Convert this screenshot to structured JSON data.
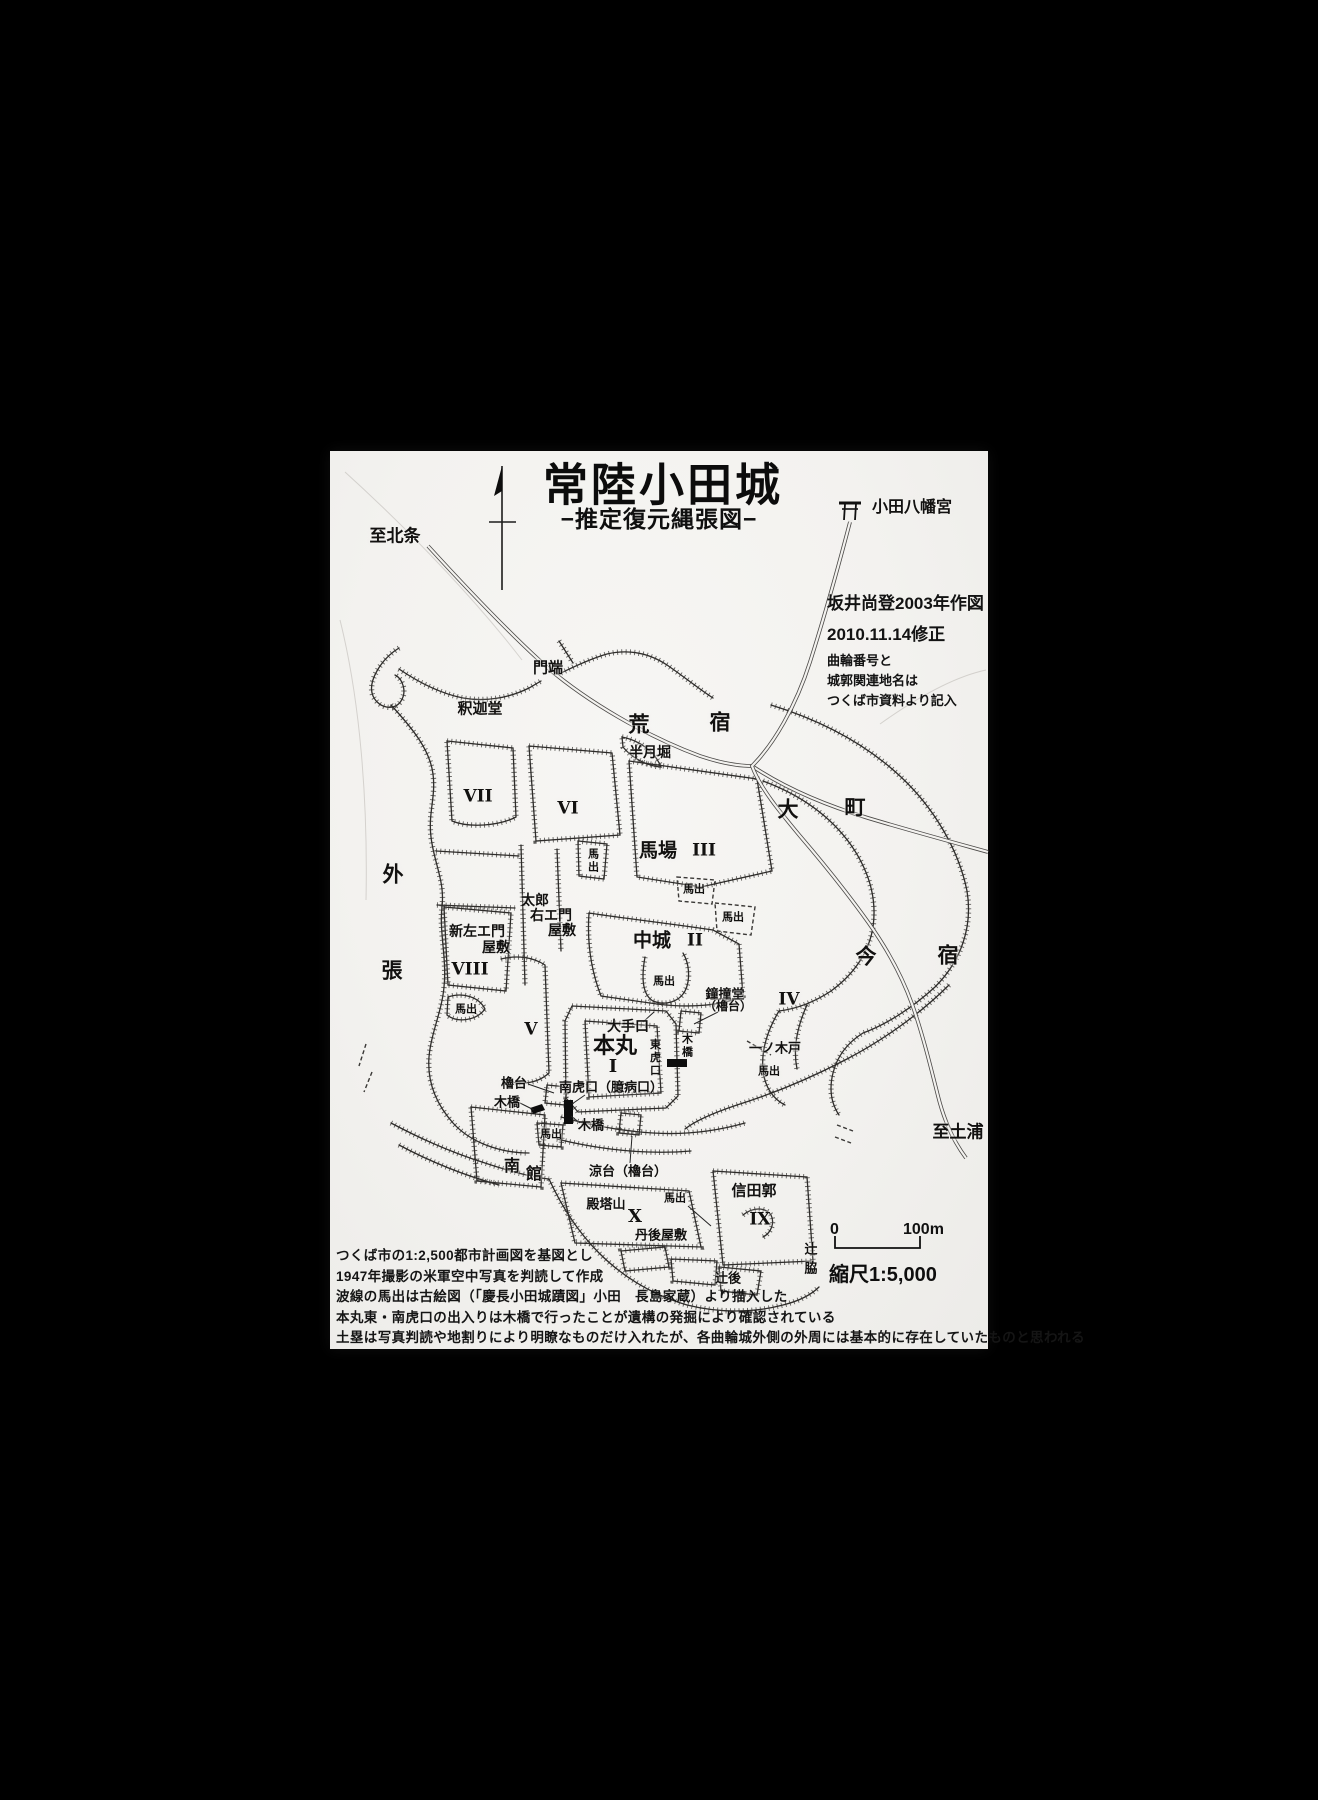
{
  "colors": {
    "background": "#000000",
    "paper": "#f3f2ef",
    "ink": "#1c1c1c"
  },
  "title": {
    "main": "常陸小田城",
    "subtitle": "−推定復元縄張図−"
  },
  "attribution": {
    "author_line": "坂井尚登2003年作図",
    "revision_line": "2010.11.14修正",
    "source_note_1": "曲輪番号と",
    "source_note_2": "城郭関連地名は",
    "source_note_3": "つくば市資料より記入"
  },
  "scale": {
    "zero": "0",
    "hundred": "100m",
    "ratio": "縮尺1:5,000"
  },
  "notes": [
    "つくば市の1:2,500都市計画図を基図とし",
    "1947年撮影の米軍空中写真を判読して作成",
    "波線の馬出は古絵図（「慶長小田城蹟図」小田　長島家蔵）より描入した",
    "本丸東・南虎口の出入りは木橋で行ったことが遺構の発掘により確認されている",
    "土塁は写真判読や地割りにより明瞭なものだけ入れたが、各曲輪城外側の外周には基本的に存在していたものと思われる"
  ],
  "map": {
    "labels": [
      {
        "id": "to-hojo",
        "text": "至北条",
        "x": 395,
        "y": 536,
        "fs": 17
      },
      {
        "id": "oda-hachimangu",
        "text": "小田八幡宮",
        "x": 912,
        "y": 508,
        "fs": 16
      },
      {
        "id": "monbata",
        "text": "門端",
        "x": 548,
        "y": 668,
        "fs": 15
      },
      {
        "id": "shakado",
        "text": "釈迦堂",
        "x": 480,
        "y": 709,
        "fs": 15
      },
      {
        "id": "ara",
        "text": "荒",
        "x": 639,
        "y": 725,
        "fs": 21
      },
      {
        "id": "shuku-ara",
        "text": "宿",
        "x": 720,
        "y": 723,
        "fs": 21
      },
      {
        "id": "hangetsubori",
        "text": "半月堀",
        "x": 650,
        "y": 752,
        "fs": 14
      },
      {
        "id": "kuruwa-7",
        "text": "VII",
        "x": 478,
        "y": 797,
        "fs": 17,
        "serif": true
      },
      {
        "id": "kuruwa-6",
        "text": "VI",
        "x": 568,
        "y": 809,
        "fs": 17,
        "serif": true
      },
      {
        "id": "dai",
        "text": "大",
        "x": 788,
        "y": 810,
        "fs": 21
      },
      {
        "id": "machi",
        "text": "町",
        "x": 855,
        "y": 808,
        "fs": 21
      },
      {
        "id": "baba",
        "text": "馬場",
        "x": 658,
        "y": 851,
        "fs": 19
      },
      {
        "id": "kuruwa-3",
        "text": "III",
        "x": 704,
        "y": 851,
        "fs": 17,
        "serif": true
      },
      {
        "id": "umadashi-1",
        "text": "馬出",
        "x": 592,
        "y": 861,
        "fs": 11,
        "vert": true
      },
      {
        "id": "umadashi-2",
        "text": "馬出",
        "x": 694,
        "y": 890,
        "fs": 11
      },
      {
        "id": "umadashi-3",
        "text": "馬出",
        "x": 733,
        "y": 918,
        "fs": 11
      },
      {
        "id": "taro",
        "text": "太郎",
        "x": 535,
        "y": 900,
        "fs": 14
      },
      {
        "id": "uemon",
        "text": "右エ門",
        "x": 551,
        "y": 915,
        "fs": 14
      },
      {
        "id": "yashiki-taro",
        "text": "屋敷",
        "x": 562,
        "y": 930,
        "fs": 14
      },
      {
        "id": "shinzaemon",
        "text": "新左エ門",
        "x": 477,
        "y": 931,
        "fs": 14
      },
      {
        "id": "yashiki-shin",
        "text": "屋敷",
        "x": 496,
        "y": 947,
        "fs": 14
      },
      {
        "id": "nakajo",
        "text": "中城",
        "x": 652,
        "y": 941,
        "fs": 19
      },
      {
        "id": "kuruwa-2",
        "text": "II",
        "x": 695,
        "y": 941,
        "fs": 17,
        "serif": true
      },
      {
        "id": "soto",
        "text": "外",
        "x": 393,
        "y": 875,
        "fs": 21
      },
      {
        "id": "hari",
        "text": "張",
        "x": 392,
        "y": 971,
        "fs": 21
      },
      {
        "id": "kuruwa-8",
        "text": "VIII",
        "x": 470,
        "y": 970,
        "fs": 17,
        "serif": true
      },
      {
        "id": "umadashi-4",
        "text": "馬出",
        "x": 466,
        "y": 1010,
        "fs": 11
      },
      {
        "id": "kuruwa-5",
        "text": "V",
        "x": 531,
        "y": 1030,
        "fs": 17,
        "serif": true
      },
      {
        "id": "umadashi-5",
        "text": "馬出",
        "x": 664,
        "y": 982,
        "fs": 11
      },
      {
        "id": "shodo",
        "text": "鐘撞堂",
        "x": 725,
        "y": 994,
        "fs": 13
      },
      {
        "id": "shodo-yagura",
        "text": "（櫓台）",
        "x": 728,
        "y": 1006,
        "fs": 12
      },
      {
        "id": "kuruwa-4",
        "text": "IV",
        "x": 789,
        "y": 1000,
        "fs": 17,
        "serif": true
      },
      {
        "id": "oteguchi",
        "text": "大手口",
        "x": 628,
        "y": 1026,
        "fs": 14
      },
      {
        "id": "honmaru",
        "text": "本丸",
        "x": 615,
        "y": 1046,
        "fs": 22
      },
      {
        "id": "kuruwa-1",
        "text": "I",
        "x": 613,
        "y": 1067,
        "fs": 18,
        "serif": true
      },
      {
        "id": "higashi-koguchi",
        "text": "東虎口",
        "x": 654,
        "y": 1058,
        "fs": 11,
        "vert": true
      },
      {
        "id": "kibashi-higashi",
        "text": "木橋",
        "x": 686,
        "y": 1046,
        "fs": 11,
        "vert": true
      },
      {
        "id": "ichinokido",
        "text": "一ノ木戸",
        "x": 775,
        "y": 1048,
        "fs": 13
      },
      {
        "id": "umadashi-6",
        "text": "馬出",
        "x": 769,
        "y": 1072,
        "fs": 11
      },
      {
        "id": "ima",
        "text": "今",
        "x": 866,
        "y": 957,
        "fs": 21
      },
      {
        "id": "shuku-ima",
        "text": "宿",
        "x": 948,
        "y": 956,
        "fs": 21
      },
      {
        "id": "yagura-sw",
        "text": "櫓台",
        "x": 514,
        "y": 1083,
        "fs": 13
      },
      {
        "id": "minami-koguchi",
        "text": "南虎口（臆病口）",
        "x": 611,
        "y": 1087,
        "fs": 13
      },
      {
        "id": "kibashi-w",
        "text": "木橋",
        "x": 507,
        "y": 1102,
        "fs": 13
      },
      {
        "id": "kibashi-s",
        "text": "木橋",
        "x": 591,
        "y": 1125,
        "fs": 13
      },
      {
        "id": "umadashi-7",
        "text": "馬出",
        "x": 551,
        "y": 1135,
        "fs": 11
      },
      {
        "id": "minami",
        "text": "南",
        "x": 512,
        "y": 1167,
        "fs": 16
      },
      {
        "id": "yakata",
        "text": "館",
        "x": 534,
        "y": 1175,
        "fs": 16
      },
      {
        "id": "suzumidai",
        "text": "涼台（櫓台）",
        "x": 628,
        "y": 1171,
        "fs": 13
      },
      {
        "id": "dentozan",
        "text": "殿塔山",
        "x": 606,
        "y": 1204,
        "fs": 13
      },
      {
        "id": "kuruwa-10",
        "text": "X",
        "x": 635,
        "y": 1217,
        "fs": 18,
        "serif": true
      },
      {
        "id": "umadashi-8",
        "text": "馬出",
        "x": 675,
        "y": 1199,
        "fs": 11
      },
      {
        "id": "tango-yashiki",
        "text": "丹後屋敷",
        "x": 661,
        "y": 1235,
        "fs": 13
      },
      {
        "id": "shidakaku",
        "text": "信田郭",
        "x": 754,
        "y": 1191,
        "fs": 15
      },
      {
        "id": "kuruwa-9",
        "text": "IX",
        "x": 760,
        "y": 1220,
        "fs": 17,
        "serif": true
      },
      {
        "id": "tsuji",
        "text": "辻",
        "x": 811,
        "y": 1249,
        "fs": 13
      },
      {
        "id": "waki",
        "text": "脇",
        "x": 811,
        "y": 1268,
        "fs": 13
      },
      {
        "id": "tsujigo",
        "text": "辻後",
        "x": 728,
        "y": 1278,
        "fs": 13
      },
      {
        "id": "to-tsuchiura",
        "text": "至土浦",
        "x": 958,
        "y": 1132,
        "fs": 17
      }
    ]
  }
}
